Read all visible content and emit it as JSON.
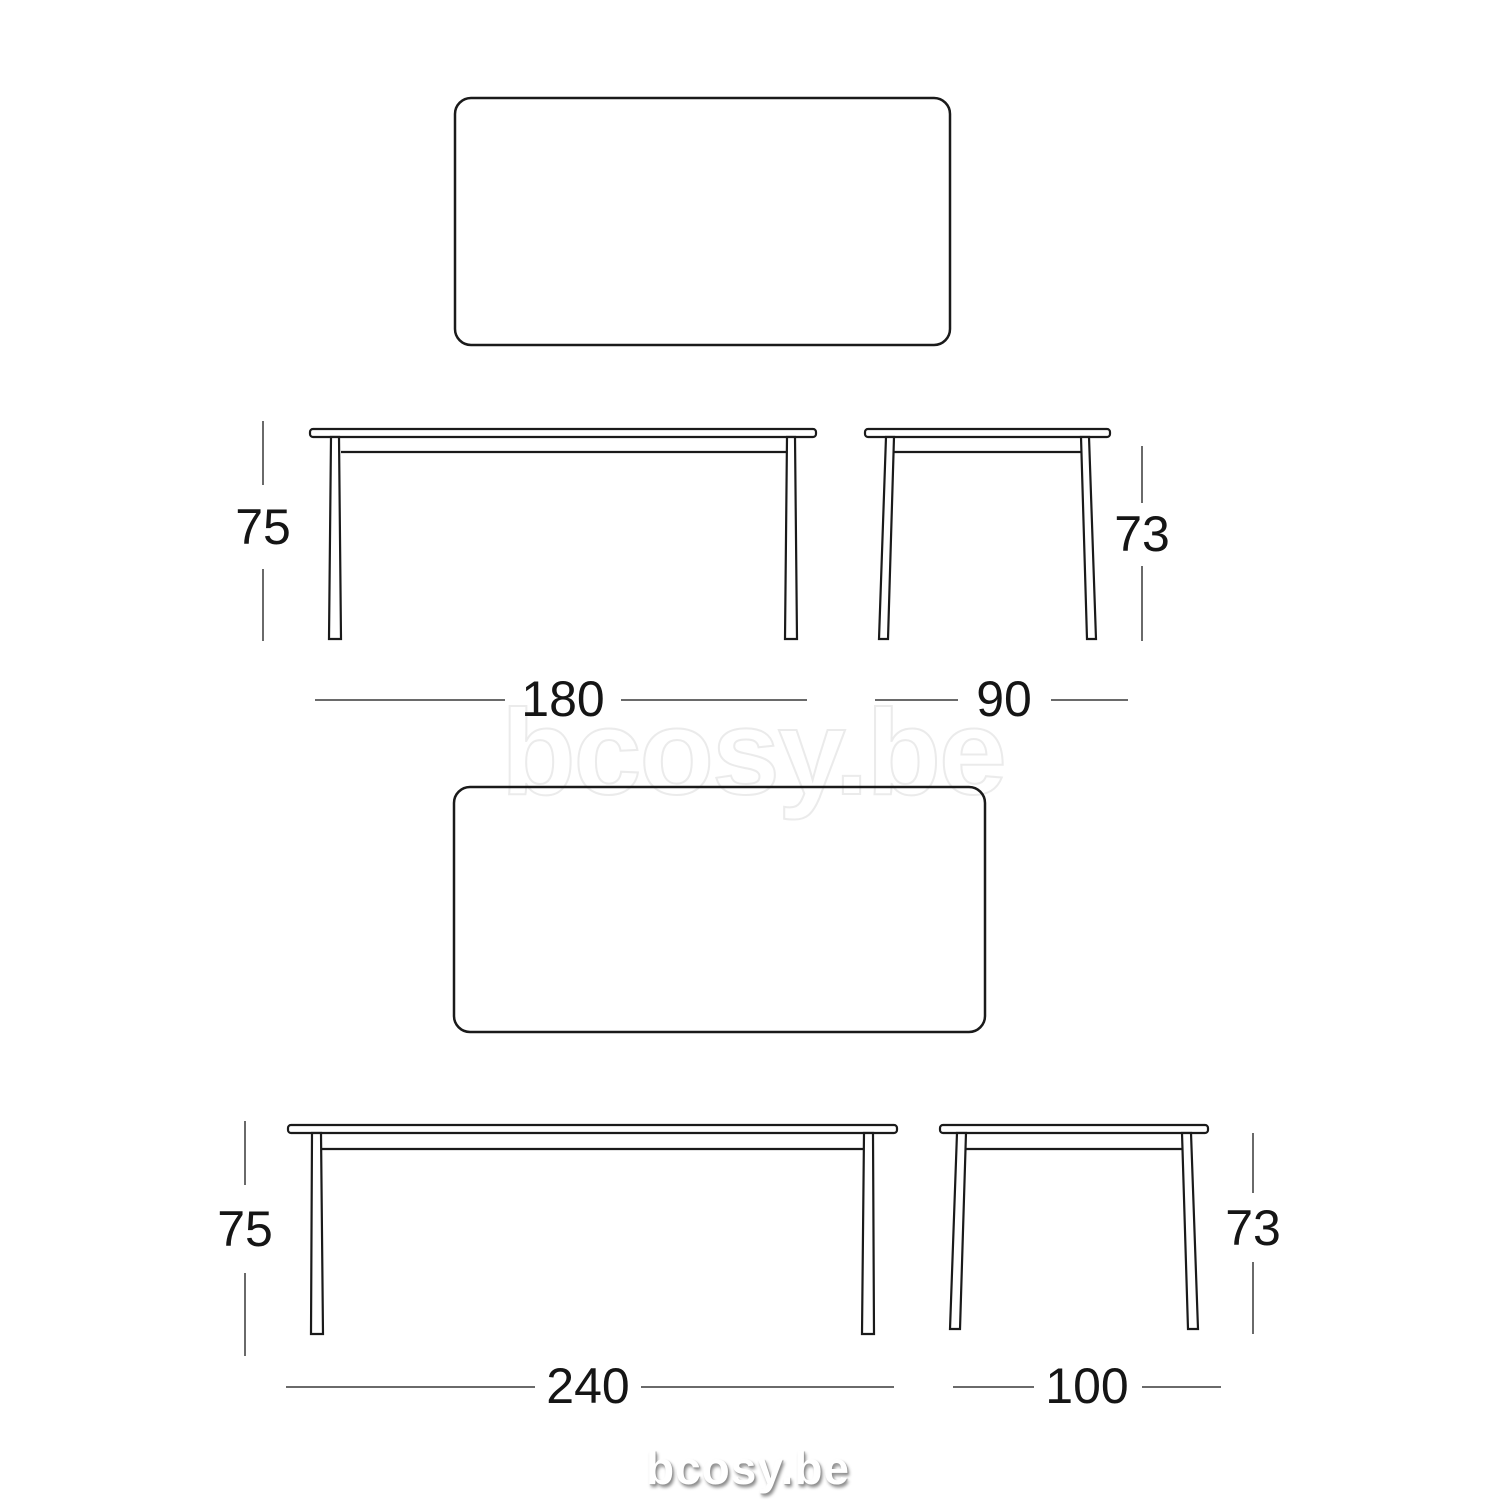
{
  "page": {
    "background": "#ffffff"
  },
  "watermarks": {
    "large": "bcosy.be",
    "footer": "bcosy.be"
  },
  "colors": {
    "outline": "#1a1a1a",
    "dimension_line": "#6a6a6a",
    "label_text": "#151515",
    "watermark_outline": "#ebebeb",
    "footer_text": "#ffffff",
    "footer_shadow": "#909090"
  },
  "views": {
    "small_table": {
      "width": "180",
      "depth": "90",
      "front_height": "75",
      "side_height": "73"
    },
    "large_table": {
      "width": "240",
      "depth": "100",
      "front_height": "75",
      "side_height": "73"
    }
  }
}
